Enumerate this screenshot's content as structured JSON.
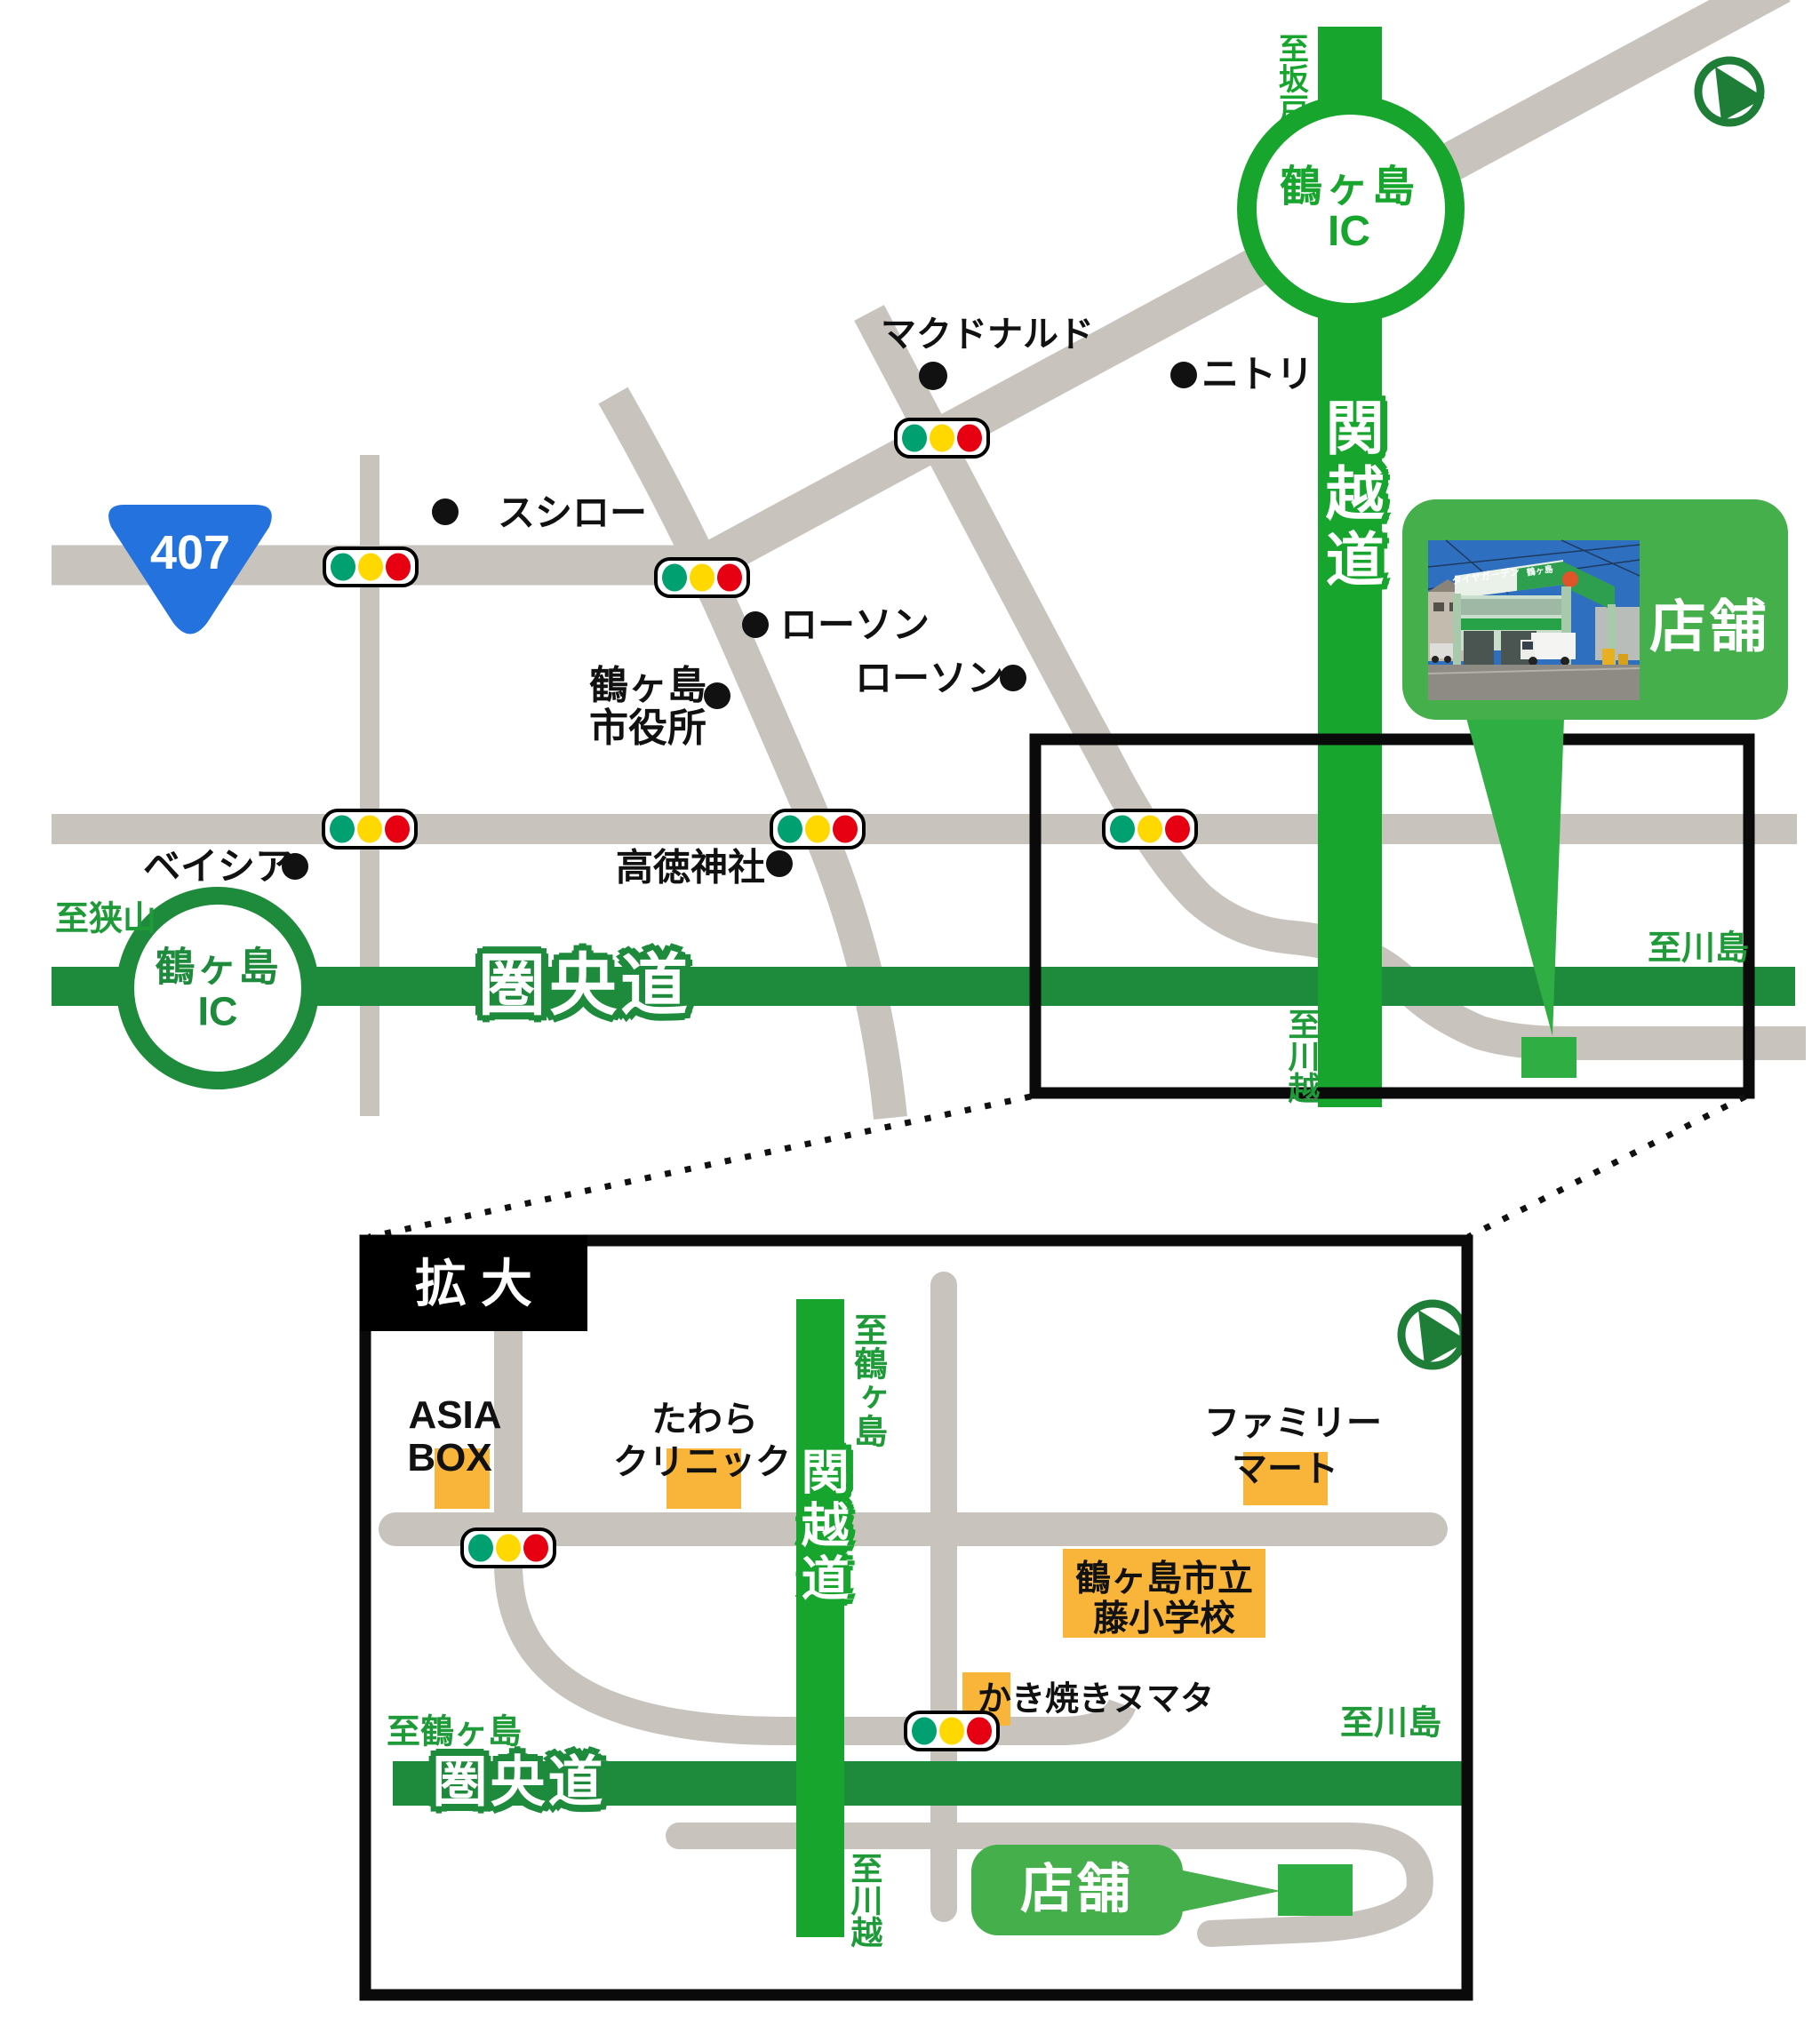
{
  "main": {
    "to_sakado": "至坂戸",
    "ic_top_name": "鶴ヶ島",
    "ic_top_ic": "IC",
    "kanetsudo": "関越道",
    "mcdonalds": "マクドナルド",
    "nitori": "ニトリ",
    "sushiro": "スシロー",
    "route_number": "407",
    "lawson_upper": "ローソン",
    "cityhall_line1": "鶴ヶ島",
    "cityhall_line2": "市役所",
    "lawson_lower": "ローソン",
    "kotoku_shrine": "高徳神社",
    "beisia": "ベイシア",
    "to_sayama": "至狭山",
    "ic_left_name": "鶴ヶ島",
    "ic_left_ic": "IC",
    "kenodo": "圏央道",
    "to_kawajima": "至川島",
    "to_kawagoe": "至川越",
    "store": "店舗"
  },
  "photo": {
    "sign_main": "タイヤガーデン",
    "sign_sub": "鶴ヶ島"
  },
  "inset": {
    "title": "拡 大",
    "to_tsurugashima_top": "至鶴ヶ島",
    "asia_box_line1": "ASIA",
    "asia_box_line2": "BOX",
    "tawara_line1": "たわら",
    "tawara_line2": "クリニック",
    "familymart_line1": "ファミリー",
    "familymart_line2": "マート",
    "school_line1": "鶴ヶ島市立",
    "school_line2": "藤小学校",
    "kanetsudo": "関越道",
    "kakiyaki": "かき焼きヌマタ",
    "to_tsurugashima_bottom": "至鶴ヶ島",
    "to_kawajima": "至川島",
    "kenodo": "圏央道",
    "to_kawagoe": "至川越",
    "store": "店舗"
  },
  "colors": {
    "kanetsu_green": "#17A52E",
    "kenodo_green": "#1E8A3C",
    "callout_green": "#44AF4B",
    "marker_green": "#2FAE44",
    "road_gray": "#C9C3BE",
    "signal_green": "#00A070",
    "signal_yellow": "#FFD800",
    "signal_red": "#E60012",
    "route_badge_blue": "#2372DE",
    "poi_orange": "#F9B53A",
    "label_green": "#1F9A38"
  }
}
